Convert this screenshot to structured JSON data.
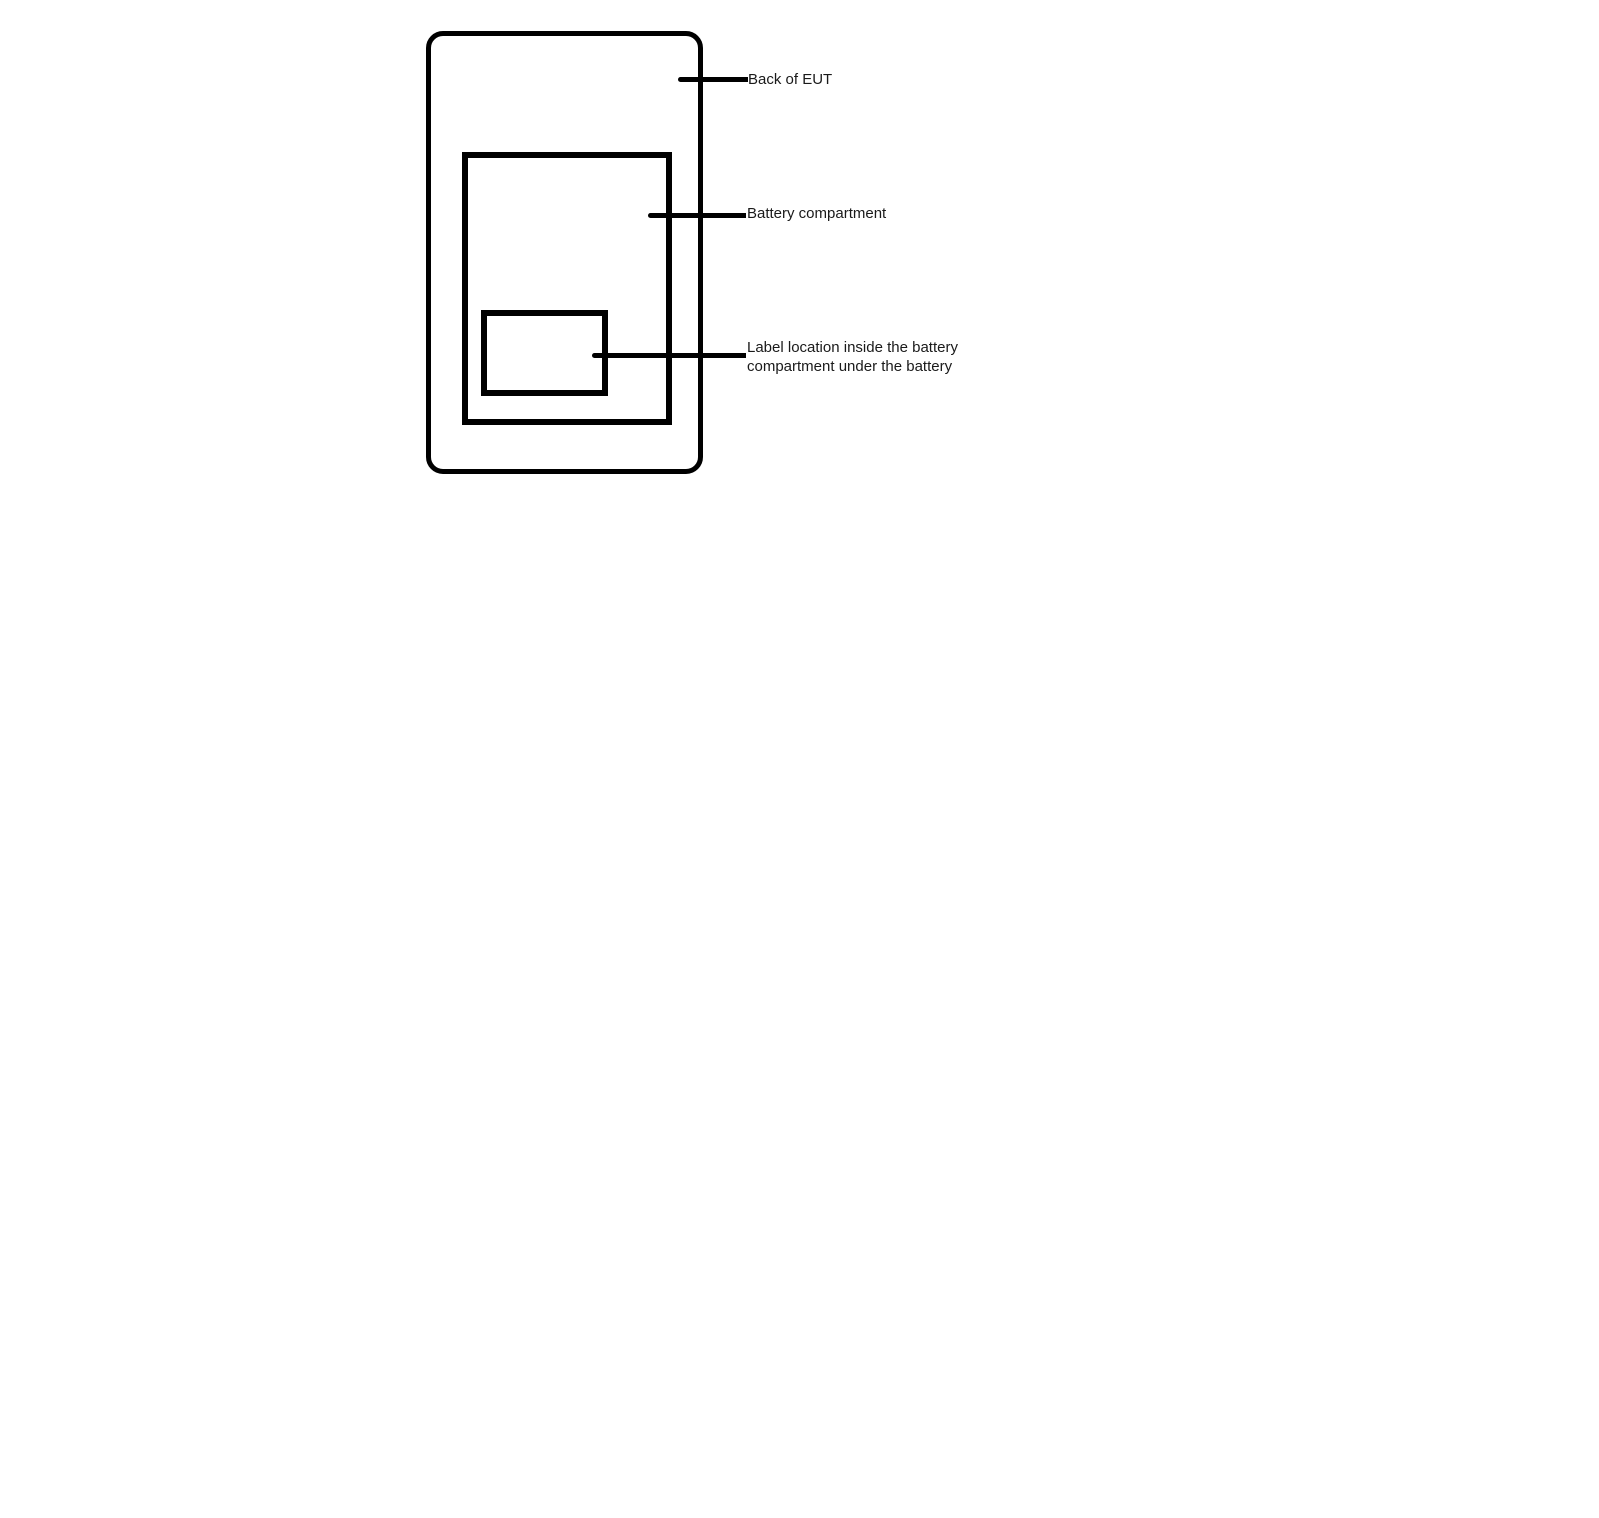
{
  "diagram": {
    "labels": {
      "back_of_eut": "Back of EUT",
      "battery_compartment": "Battery compartment",
      "label_location_lines": [
        "Label location inside the battery",
        "compartment under the battery"
      ]
    },
    "colors": {
      "stroke": "#000000",
      "background": "#ffffff",
      "text": "#1a1a1a"
    }
  }
}
